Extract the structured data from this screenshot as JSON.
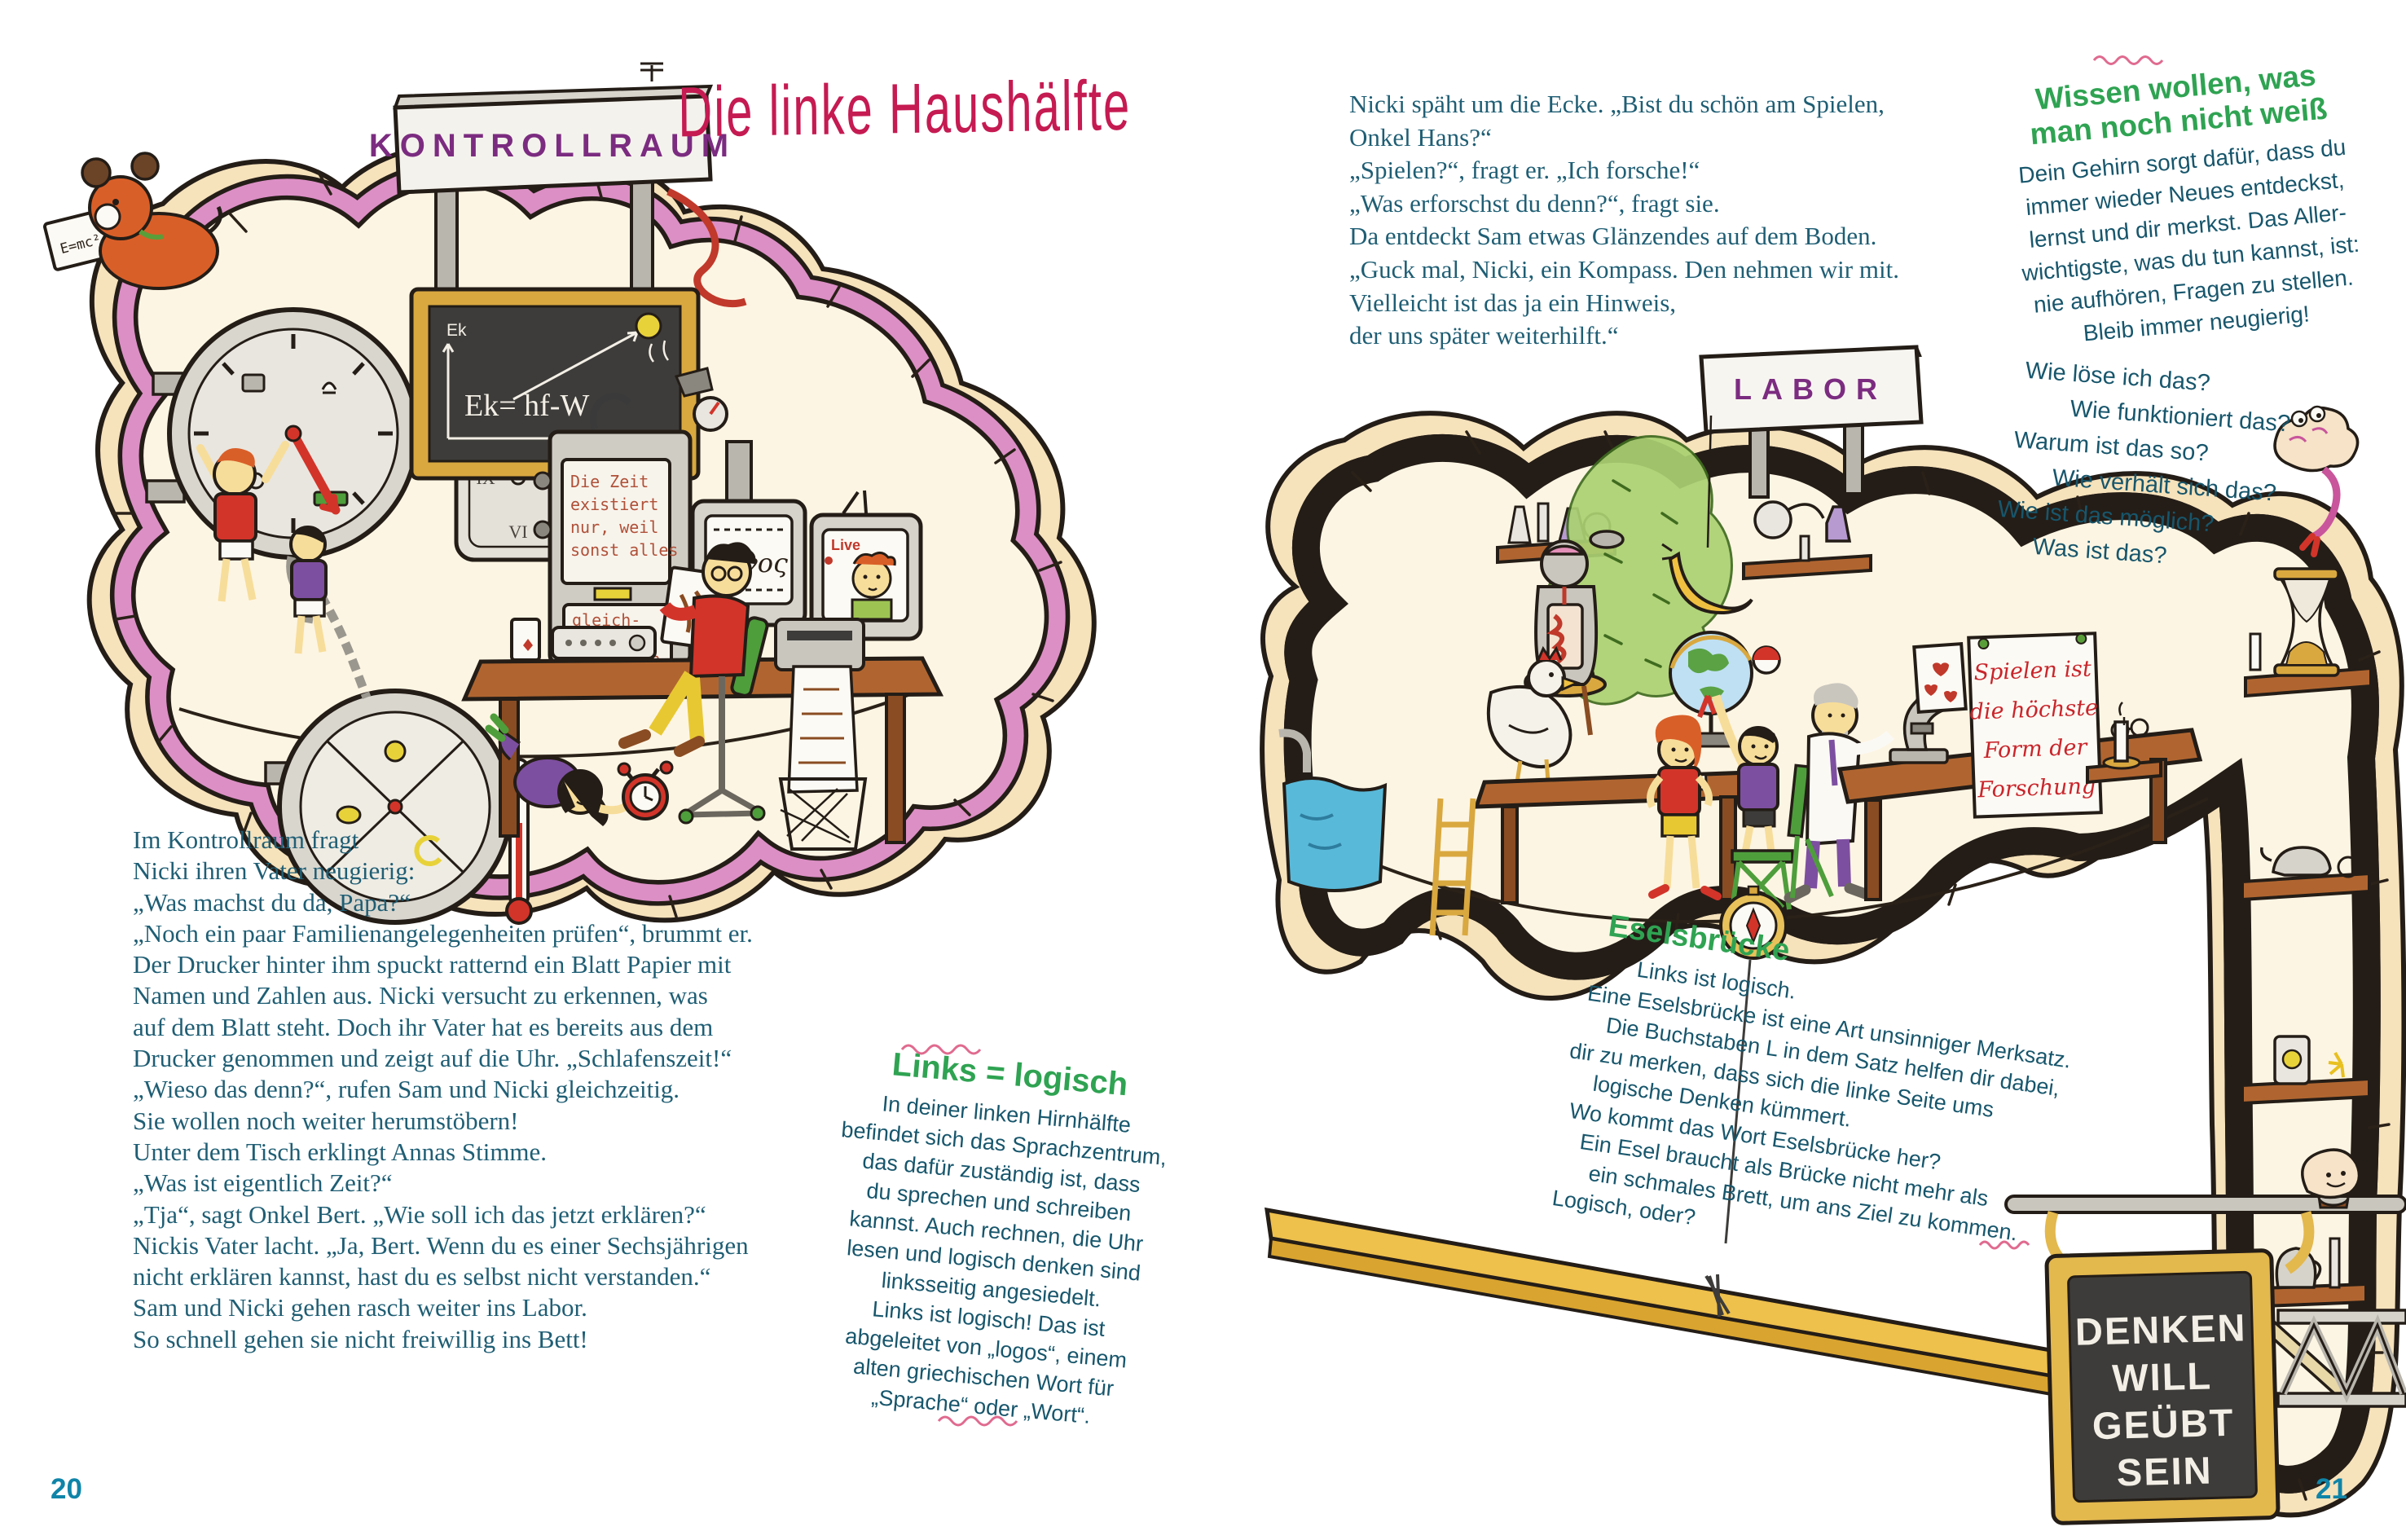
{
  "page_left": {
    "page_number": "20",
    "title": "Die linke Haushälfte",
    "sign": "KONTROLLRAUM",
    "story": [
      "Im Kontrollraum fragt",
      "Nicki ihren Vater neugierig:",
      "„Was machst du da, Papa?“",
      "„Noch ein paar Familienangelegenheiten prüfen“, brummt er.",
      "Der Drucker hinter ihm spuckt ratternd ein Blatt Papier mit",
      "Namen und Zahlen aus. Nicki versucht zu erkennen, was",
      "auf dem Blatt steht. Doch ihr Vater hat es bereits aus dem",
      "Drucker genommen und zeigt auf die Uhr. „Schlafenszeit!“",
      "„Wieso das denn?“, rufen Sam und Nicki gleichzeitig.",
      "Sie wollen noch weiter herumstöbern!",
      "Unter dem Tisch erklingt Annas Stimme.",
      "„Was ist eigentlich Zeit?“",
      "„Tja“, sagt Onkel Bert. „Wie soll ich das jetzt erklären?“",
      "Nickis Vater lacht. „Ja, Bert. Wenn du es einer Sechsjährigen",
      "nicht erklären kannst, hast du es selbst nicht verstanden.“",
      "Sam und Nicki gehen rasch weiter ins Labor.",
      "So schnell gehen sie nicht freiwillig ins Bett!"
    ],
    "infobox": {
      "heading": "Links = logisch",
      "lines": [
        "In deiner linken Hirnhälfte",
        "befindet sich das Sprachzentrum,",
        "das dafür zuständig ist, dass",
        "du sprechen und schreiben",
        "kannst. Auch rechnen, die Uhr",
        "lesen und logisch denken sind",
        "linksseitig angesiedelt.",
        "Links ist logisch! Das ist",
        "abgeleitet von „logos“, einem",
        "alten griechischen Wort für",
        "„Sprache“ oder „Wort“."
      ]
    },
    "art": {
      "dog_paper": "E=mc²",
      "axis_y": "Ek",
      "formula": "Ek= hf-W",
      "axis_x": "f",
      "machine_top": [
        "Die Zeit",
        "existiert",
        "nur, weil",
        "sonst alles"
      ],
      "machine_bottom": [
        "gleich-",
        "zeitig",
        "passieren",
        "würde"
      ],
      "monitor": "λόγος",
      "tv": "Live",
      "roman": [
        "XII",
        "III",
        "VI",
        "IX"
      ]
    }
  },
  "page_right": {
    "page_number": "21",
    "sign": "LABOR",
    "story": [
      "Nicki späht um die Ecke. „Bist du schön am Spielen,",
      "Onkel Hans?“",
      "„Spielen?“, fragt er. „Ich forsche!“",
      "„Was erforschst du denn?“, fragt sie.",
      "Da entdeckt Sam etwas Glänzendes auf dem Boden.",
      "„Guck mal, Nicki, ein Kompass. Den nehmen wir mit.",
      "Vielleicht ist das ja ein Hinweis,",
      "der uns später weiterhilft.“"
    ],
    "wissen": {
      "heading_lines": [
        "Wissen wollen, was",
        "man noch nicht weiß"
      ],
      "lines": [
        "Dein Gehirn sorgt dafür, dass du",
        "immer wieder Neues entdeckst,",
        "lernst und dir merkst. Das Aller-",
        "wichtigste, was du tun kannst, ist:",
        "nie aufhören, Fragen zu stellen.",
        "Bleib immer neugierig!"
      ]
    },
    "questions": [
      "Wie löse ich das?",
      "Wie funktioniert das?",
      "Warum ist das so?",
      "Wie verhält sich das?",
      "Wie ist das möglich?",
      "Was ist das?"
    ],
    "esel": {
      "heading": "Eselsbrücke",
      "lines": [
        "Links ist logisch.",
        "Eine Eselsbrücke ist eine Art unsinniger Merksatz.",
        "Die Buchstaben L in dem Satz helfen dir dabei,",
        "dir zu merken, dass sich die linke Seite ums",
        "logische Denken kümmert.",
        "Wo kommt das Wort Eselsbrücke her?",
        "Ein Esel braucht als Brücke nicht mehr als",
        "ein schmales Brett, um ans Ziel zu kommen.",
        "Logisch, oder?"
      ]
    },
    "poster": [
      "Spielen ist",
      "die höchste",
      "Form der",
      "Forschung"
    ],
    "chalkboard": [
      "DENKEN",
      "WILL",
      "GEÜBT",
      "SEIN"
    ]
  },
  "colors": {
    "body_text": "#1f5e74",
    "green_heading": "#2fa352",
    "title_crimson": "#c51a52",
    "sign_purple": "#7b2c80",
    "page_number_teal": "#0f84a8",
    "ribbon_pink": "#dc8fc5",
    "wall_tan": "#f6e2bb",
    "room_cream": "#fdf5e3",
    "poster_red": "#c9252b",
    "plank_yellow": "#eec04c"
  }
}
